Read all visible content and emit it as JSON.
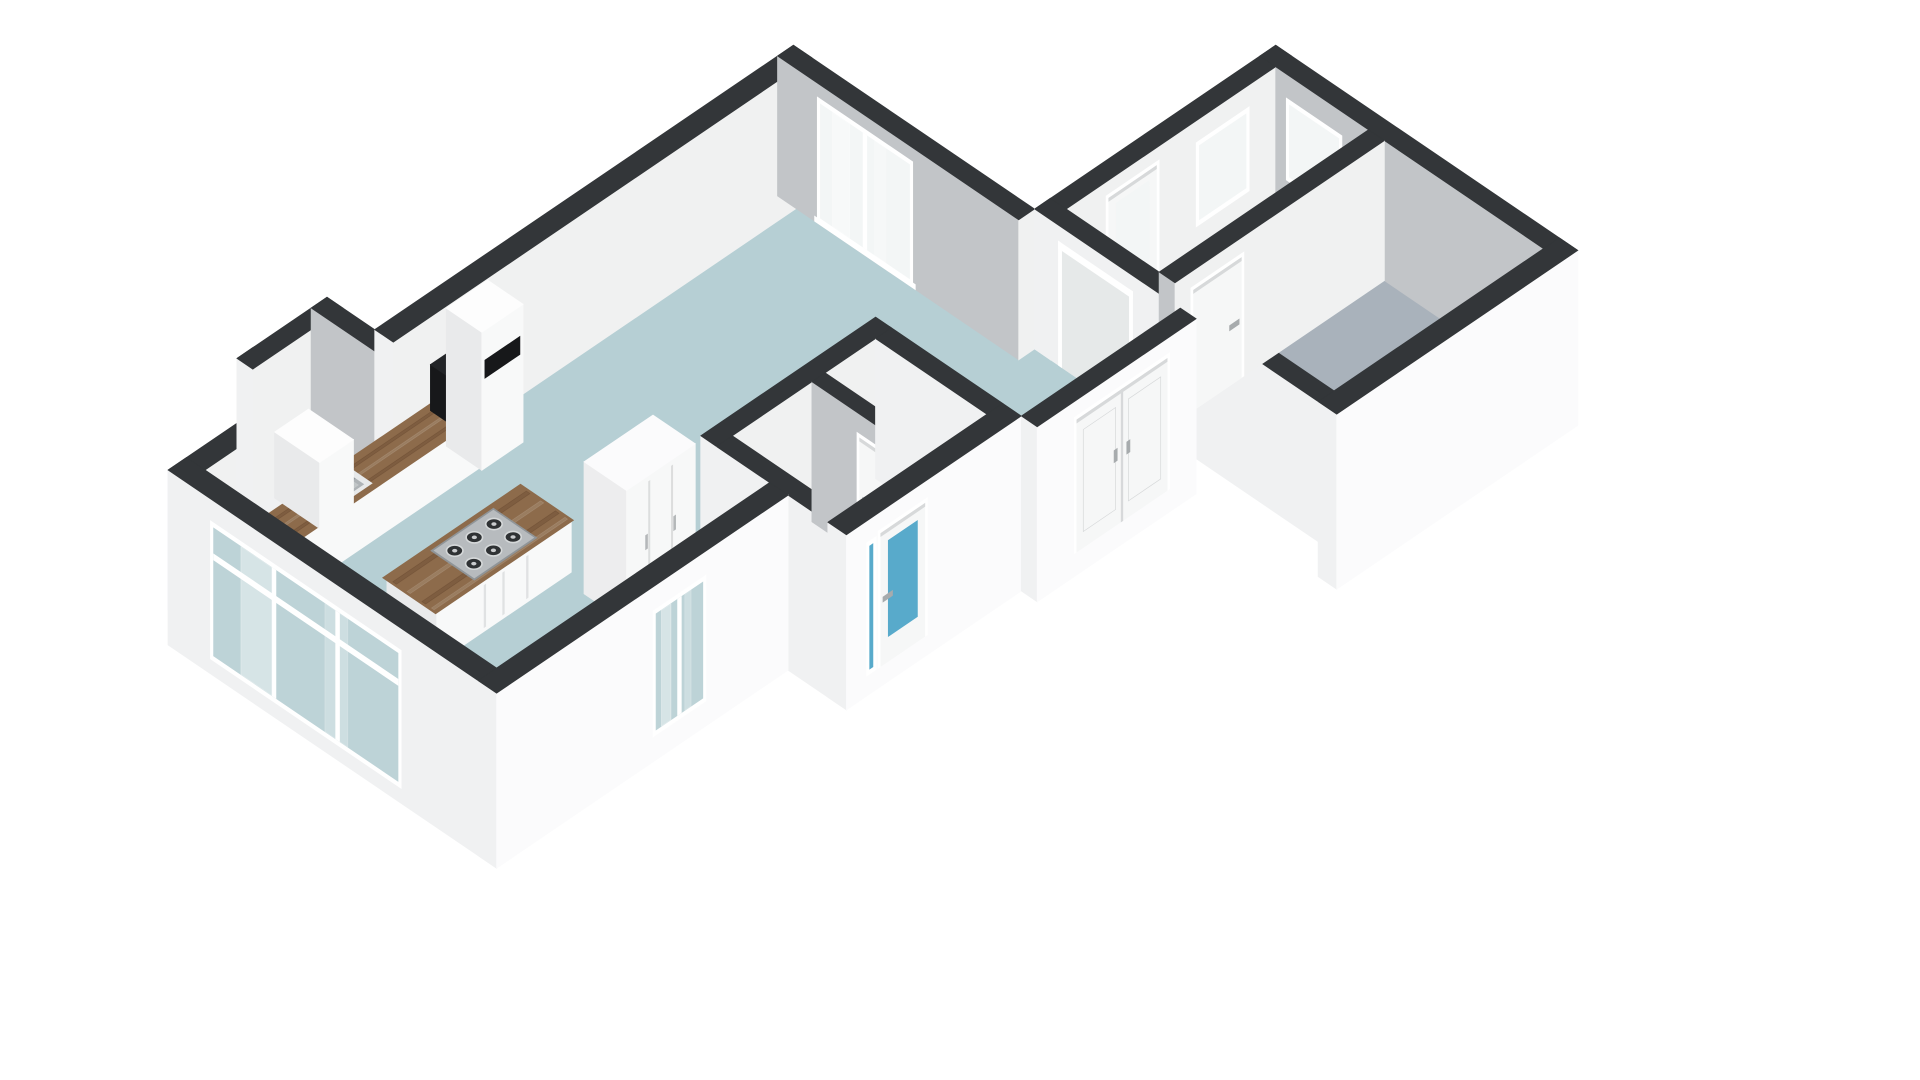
{
  "meta": {
    "view_label": "3d-floorplan-render",
    "background": "#ffffff"
  },
  "palette": {
    "cap": "#333639",
    "extU": "#f0f1f2",
    "extV": "#fbfbfc",
    "intU": "#c2c5c8",
    "intV": "#f0f1f1",
    "box_u": "#e9eaeb",
    "box_v": "#f8f9f9",
    "box_top": "#fdfdfd",
    "floor_living": "#b6cfd4",
    "floor_bedroom": "#a9b2bb",
    "floor_bath": "#4ea5c7",
    "floor_hall": "#e9eceb",
    "floor_lobby": "#dde1e2",
    "floor_niche": "#f6f7f7",
    "wood": "#8d6b4b",
    "wood_dark": "rgba(60,35,15,0.18)",
    "wood_light": "rgba(255,255,255,0.12)",
    "steel": "#b7bbbe",
    "steel_edge": "#909598",
    "burner": "#2f3234",
    "burner_ring": "#d5d8d9",
    "burner_dot": "#caccce",
    "black": "#17181a",
    "black_top": "#222427",
    "glass_plain": "#f3f6f6",
    "glass_teal": "#bdd3d7",
    "glass_blue": "#58aacb",
    "frame": "#ffffff",
    "leaf": "#f6f7f7",
    "seam": "#d7d9da",
    "handle": "#a7abad",
    "sink_rim": "#e7e9ea",
    "sink_basin": "#aeb3b6",
    "sink_shadow": "#8d9295",
    "open_fill": "#e6e9e9",
    "streak": "#ffffff"
  },
  "projection": {
    "A": 53,
    "B": 36,
    "OX": 168,
    "OY": 610,
    "wall_top": 140,
    "slab": -35
  },
  "scene": {
    "floors": [
      {
        "name": "floor-living-room",
        "color": "floor_living",
        "pts": [
          [
            0.35,
            0.35
          ],
          [
            11.5,
            0.35
          ],
          [
            11.5,
            4.55
          ],
          [
            0.35,
            4.55
          ]
        ]
      },
      {
        "name": "floor-kitchen-zone",
        "color": "floor_living",
        "pts": [
          [
            0.35,
            4.5
          ],
          [
            5.5,
            4.5
          ],
          [
            5.5,
            5.85
          ],
          [
            0.35,
            5.85
          ]
        ]
      },
      {
        "name": "floor-entry-area",
        "color": "floor_living",
        "pts": [
          [
            8.8,
            4.5
          ],
          [
            11.8,
            4.5
          ],
          [
            11.8,
            7.3
          ],
          [
            8.8,
            7.3
          ]
        ]
      },
      {
        "name": "floor-niche",
        "color": "floor_niche",
        "pts": [
          [
            2.5,
            -0.6
          ],
          [
            3.6,
            -0.6
          ],
          [
            3.6,
            0.37
          ],
          [
            2.5,
            0.37
          ]
        ]
      },
      {
        "name": "floor-bathroom",
        "color": "floor_bath",
        "pts": [
          [
            5.8,
            4.85
          ],
          [
            7.3,
            4.85
          ],
          [
            7.3,
            6.95
          ],
          [
            5.8,
            6.95
          ]
        ]
      },
      {
        "name": "floor-toilet",
        "color": "floor_bath",
        "pts": [
          [
            7.55,
            4.85
          ],
          [
            8.5,
            4.85
          ],
          [
            8.5,
            5.95
          ],
          [
            7.55,
            5.95
          ]
        ]
      },
      {
        "name": "floor-lobby-cell",
        "color": "floor_lobby",
        "pts": [
          [
            7.55,
            6.2
          ],
          [
            8.5,
            6.2
          ],
          [
            8.5,
            6.95
          ],
          [
            7.55,
            6.95
          ]
        ]
      },
      {
        "name": "floor-hallway",
        "color": "floor_hall",
        "pts": [
          [
            12.1,
            4.85
          ],
          [
            16.05,
            4.85
          ],
          [
            16.05,
            6.6
          ],
          [
            12.1,
            6.6
          ]
        ]
      },
      {
        "name": "floor-bedroom",
        "color": "floor_bedroom",
        "pts": [
          [
            12.1,
            6.9
          ],
          [
            16.05,
            6.9
          ],
          [
            16.05,
            9.9
          ],
          [
            12.1,
            9.9
          ]
        ]
      }
    ],
    "walls_back": [
      {
        "name": "wall-nw-left",
        "u1": 0,
        "v1": 0,
        "u2": 2.2,
        "v2": 0.35,
        "cu": "extU",
        "cv": "intV"
      },
      {
        "name": "wall-niche-west",
        "u1": 2.2,
        "v1": -0.9,
        "u2": 2.5,
        "v2": 0.35,
        "cu": "extU",
        "cv": "intV"
      },
      {
        "name": "wall-niche-north",
        "u1": 2.2,
        "v1": -0.9,
        "u2": 3.9,
        "v2": -0.6,
        "cu": "extU",
        "cv": "intV"
      },
      {
        "name": "wall-niche-east",
        "u1": 3.6,
        "v1": -0.9,
        "u2": 3.9,
        "v2": 0.35,
        "cu": "intU",
        "cv": "intV"
      },
      {
        "name": "wall-nw-main",
        "u1": 3.9,
        "v1": 0,
        "u2": 11.8,
        "v2": 0.35,
        "cu": "extU",
        "cv": "intV"
      },
      {
        "name": "wall-living-ne",
        "u1": 11.5,
        "v1": 0,
        "u2": 11.8,
        "v2": 4.55,
        "cu": "intU",
        "cv": "intV",
        "items": [
          {
            "name": "living-room-french-window",
            "kind": "window",
            "side": "u",
            "t1": 0.75,
            "t2": 2.55,
            "z1": 2,
            "z2": 126,
            "glass": "glass_plain",
            "mullions": [
              1.65
            ],
            "sill": true,
            "streaks": true
          }
        ]
      },
      {
        "name": "wall-hall-nw",
        "u1": 11.8,
        "v1": 4.55,
        "u2": 16.35,
        "v2": 4.85,
        "cu": "extU",
        "cv": "intV",
        "items": [
          {
            "name": "front-door",
            "kind": "door",
            "side": "v",
            "t1": 12.9,
            "t2": 13.8,
            "z1": 0,
            "z2": 122,
            "glass": "glass_plain",
            "g1": 34,
            "g2": 112,
            "handle_t": 13.02,
            "hz": 56
          },
          {
            "name": "hall-window-nw",
            "kind": "window",
            "side": "v",
            "t1": 14.55,
            "t2": 15.55,
            "z1": 34,
            "z2": 118,
            "glass": "glass_plain",
            "mullions": []
          }
        ]
      },
      {
        "name": "wall-wing-ne",
        "u1": 16.05,
        "v1": 4.85,
        "u2": 16.35,
        "v2": 9.9,
        "cu": "intU",
        "cv": "extV",
        "cap": {
          "u1": 16.05,
          "v1": 4.55,
          "u2": 16.35,
          "v2": 10.25
        },
        "items": [
          {
            "name": "hall-window-ne",
            "kind": "window",
            "side": "u",
            "t1": 5.05,
            "t2": 6.1,
            "z1": 34,
            "z2": 116,
            "glass": "glass_plain",
            "mullions": []
          }
        ]
      },
      {
        "name": "wall-bath-nw",
        "u1": 5.5,
        "v1": 4.55,
        "u2": 8.8,
        "v2": 4.85,
        "cu": "extU",
        "cv": "intV"
      }
    ],
    "furniture": [
      {
        "name": "kitchen-corner-box",
        "kind": "box",
        "u1": 0.38,
        "v1": 0.38,
        "u2": 0.92,
        "v2": 0.95,
        "z1": 0,
        "z2": 50
      },
      {
        "name": "kitchen-counter",
        "kind": "counter",
        "u1": 0.8,
        "v1": 0.35,
        "u2": 4.9,
        "v2": 0.97,
        "h": 52,
        "black_front": {
          "t1": 0.84,
          "t2": 1.58,
          "z1": 5,
          "z2": 47
        },
        "sink": {
          "u1": 2.05,
          "v1": 0.44,
          "u2": 2.95,
          "v2": 0.9,
          "b1u": 2.14,
          "b1v": 0.51,
          "b2u": 2.86,
          "b2v": 0.83
        },
        "faucet": {
          "u": 2.52,
          "v": 0.46
        }
      },
      {
        "name": "counter-black-appliance",
        "kind": "blackbox",
        "u1": 4.55,
        "v1": 0.4,
        "u2": 4.9,
        "v2": 0.95,
        "z1": 50,
        "z2": 96
      },
      {
        "name": "kitchen-tall-cabinet",
        "kind": "box",
        "u1": 4.9,
        "v1": 0.35,
        "u2": 5.68,
        "v2": 1.02,
        "z1": 0,
        "z2": 138,
        "slot": {
          "t1": 4.96,
          "t2": 5.62,
          "z1": 90,
          "z2": 108
        }
      },
      {
        "name": "niche-cabinet",
        "kind": "box",
        "u1": 2.56,
        "v1": -0.55,
        "u2": 3.2,
        "v2": 0.3,
        "z1": 0,
        "z2": 66
      },
      {
        "name": "kitchen-island",
        "kind": "island",
        "u1": 1.75,
        "v1": 2.3,
        "u2": 4.35,
        "v2": 3.3,
        "h": 52,
        "seams": [
          2.7,
          3.05,
          3.5
        ],
        "cooktop": {
          "u1": 2.6,
          "v1": 2.42,
          "u2": 3.72,
          "v2": 3.18,
          "cols": [
            2.79,
            3.16,
            3.53
          ],
          "rows": [
            2.62,
            2.98
          ]
        }
      },
      {
        "name": "living-room-wardrobe",
        "kind": "wardrobe",
        "u1": 4.15,
        "v1": 3.7,
        "u2": 5.45,
        "v2": 4.5,
        "z1": 0,
        "z2": 132,
        "seams": [
          4.58,
          5.01
        ],
        "handles": [
          4.53,
          5.06
        ]
      }
    ],
    "walls_front": [
      {
        "name": "wall-bath-sw",
        "u1": 5.5,
        "v1": 4.85,
        "u2": 5.8,
        "v2": 7.3,
        "zb": -35,
        "cu": "extU",
        "cv": "extV"
      },
      {
        "name": "wall-bath-partition",
        "u1": 7.3,
        "v1": 4.85,
        "u2": 7.55,
        "v2": 6.95,
        "cu": "intU",
        "cv": "intV",
        "items": [
          {
            "name": "bathroom-door",
            "kind": "door",
            "side": "u",
            "t1": 5.75,
            "t2": 6.6,
            "z1": 0,
            "z2": 116,
            "handle_t": 5.9,
            "hz": 54
          }
        ]
      },
      {
        "name": "wall-toilet-partition",
        "u1": 7.55,
        "v1": 5.95,
        "u2": 8.5,
        "v2": 6.2,
        "cu": "intU",
        "cv": "intV",
        "items": [
          {
            "name": "toilet-door",
            "kind": "door",
            "side": "v",
            "t1": 7.68,
            "t2": 8.36,
            "z1": 0,
            "z2": 112,
            "handle_t": 8.22,
            "hz": 52
          }
        ]
      },
      {
        "name": "wall-bath-ne",
        "u1": 8.5,
        "v1": 4.85,
        "u2": 8.8,
        "v2": 6.95,
        "cu": "extU",
        "cv": "intV"
      },
      {
        "name": "wall-bath-se",
        "u1": 5.5,
        "v1": 6.95,
        "u2": 8.8,
        "v2": 7.3,
        "zb": -35,
        "cu": "extU",
        "cv": "extV",
        "items": [
          {
            "name": "bathroom-sidelight",
            "kind": "window",
            "side": "v",
            "t1": 5.88,
            "t2": 6.06,
            "z1": -15,
            "z2": 118,
            "glass": "glass_blue",
            "mullions": []
          },
          {
            "name": "bathroom-glazed-door",
            "kind": "door",
            "side": "v",
            "t1": 6.15,
            "t2": 6.98,
            "z1": -15,
            "z2": 118,
            "glass": "glass_blue",
            "g1": 10,
            "g2": 106,
            "handle_t": 6.28,
            "hz": 48
          }
        ]
      },
      {
        "name": "wall-wing-sw",
        "u1": 11.8,
        "v1": 4.55,
        "u2": 12.1,
        "v2": 10.25,
        "zb": 0,
        "cu": "extU",
        "cv": "extV",
        "items": [
          {
            "name": "hall-opening",
            "kind": "opening",
            "side": "u",
            "t1": 5.0,
            "t2": 6.4,
            "z1": 0,
            "z2": 124
          }
        ]
      },
      {
        "name": "wall-bedroom-nw",
        "u1": 12.1,
        "v1": 6.6,
        "u2": 16.05,
        "v2": 6.9,
        "cu": "intU",
        "cv": "intV",
        "items": [
          {
            "name": "bedroom-door",
            "kind": "door",
            "side": "v",
            "t1": 12.45,
            "t2": 13.35,
            "z1": 0,
            "z2": 120,
            "handle_t": 13.22,
            "hz": 55
          }
        ]
      },
      {
        "name": "wall-entry-se",
        "u1": 8.8,
        "v1": 7.3,
        "u2": 11.8,
        "v2": 7.6,
        "zb": -35,
        "cu": "extU",
        "cv": "extV",
        "items": [
          {
            "name": "entry-double-doors",
            "kind": "double_door",
            "side": "v",
            "t1": 9.55,
            "t2": 11.25,
            "z1": -12,
            "z2": 120,
            "seam_t": 10.4,
            "handles": [
              10.28,
              10.52
            ],
            "hz": 52
          }
        ]
      },
      {
        "name": "wall-bedroom-se",
        "u1": 11.8,
        "v1": 9.9,
        "u2": 16.35,
        "v2": 10.25,
        "zb": -35,
        "cu": "extU",
        "cv": "extV"
      },
      {
        "name": "wall-west",
        "u1": 0,
        "v1": 0,
        "u2": 0.35,
        "v2": 6.2,
        "zb": -35,
        "cu": "extU",
        "cv": "extV",
        "items": [
          {
            "name": "living-room-glazing-west",
            "kind": "window",
            "side": "u",
            "t1": 0.8,
            "t2": 4.4,
            "z1": -20,
            "z2": 118,
            "glass": "glass_teal",
            "mullions": [
              2.0,
              3.2
            ],
            "rails": [
              84
            ],
            "streaks": true
          }
        ]
      },
      {
        "name": "wall-sw",
        "u1": 0,
        "v1": 5.85,
        "u2": 5.5,
        "v2": 6.2,
        "zb": -35,
        "cu": "extU",
        "cv": "extV",
        "items": [
          {
            "name": "kitchen-window-sw",
            "kind": "window",
            "side": "v",
            "t1": 2.95,
            "t2": 3.95,
            "z1": -10,
            "z2": 116,
            "glass": "glass_teal",
            "mullions": [
              3.45
            ],
            "streaks": true
          }
        ]
      }
    ]
  }
}
